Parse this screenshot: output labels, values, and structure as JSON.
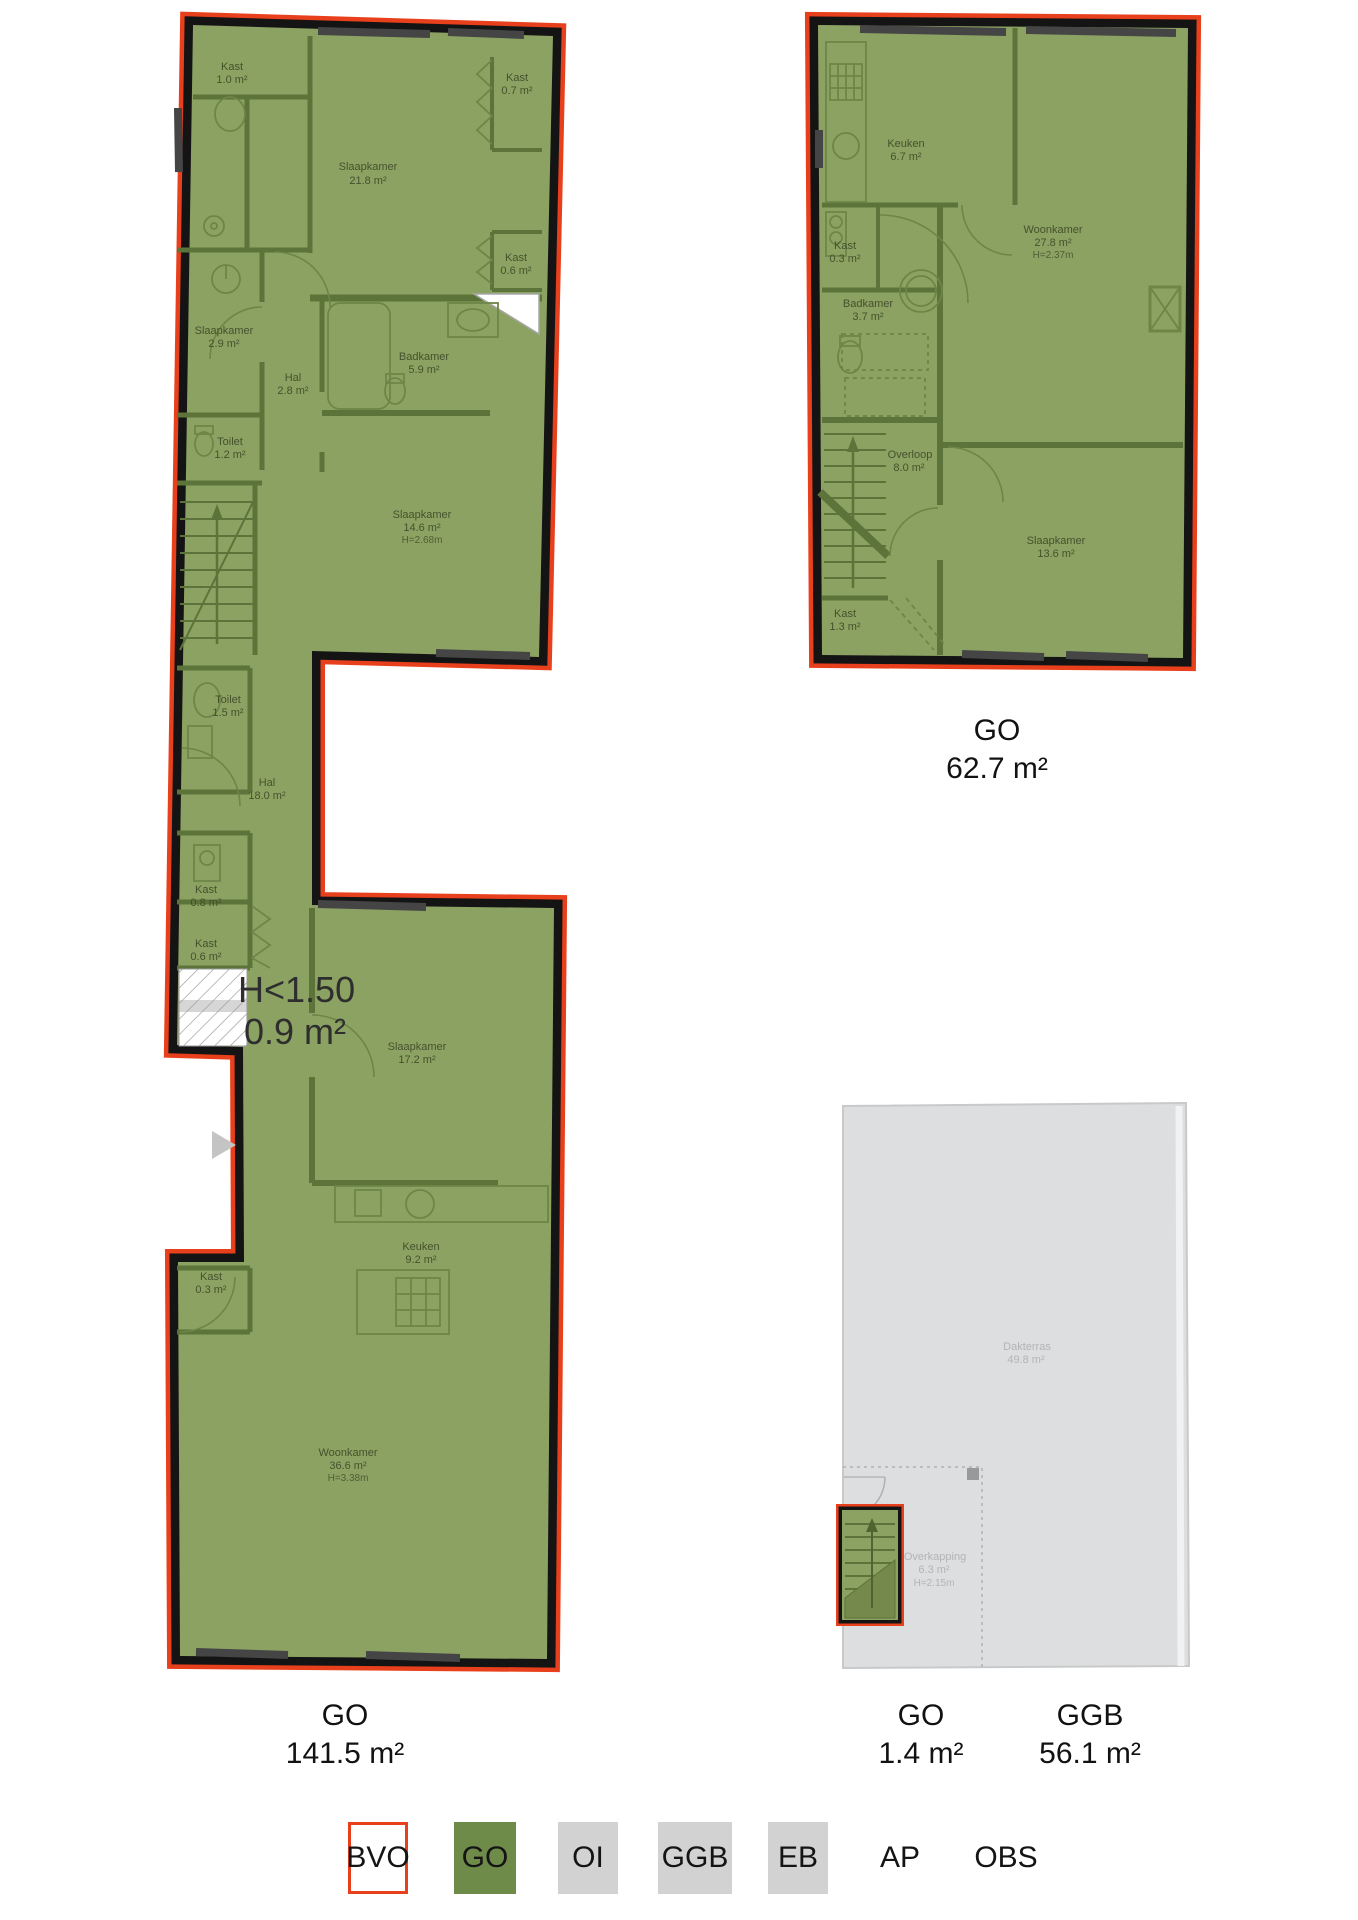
{
  "plans": {
    "plan1": {
      "area_label": {
        "type": "GO",
        "value": "141.5 m²"
      },
      "low_height": {
        "line1": "H<1.50",
        "line2": "0.9 m²"
      },
      "rooms": {
        "kast_tl": {
          "name": "Kast",
          "area": "1.0 m²"
        },
        "slaapkamer_218": {
          "name": "Slaapkamer",
          "area": "21.8 m²"
        },
        "kast_tr": {
          "name": "Kast",
          "area": "0.7 m²"
        },
        "kast_r": {
          "name": "Kast",
          "area": "0.6 m²"
        },
        "slaapkamer_29": {
          "name": "Slaapkamer",
          "area": "2.9 m²"
        },
        "hal_28": {
          "name": "Hal",
          "area": "2.8 m²"
        },
        "badkamer": {
          "name": "Badkamer",
          "area": "5.9 m²"
        },
        "toilet_12": {
          "name": "Toilet",
          "area": "1.2 m²"
        },
        "slaapkamer_146": {
          "name": "Slaapkamer",
          "area": "14.6 m²",
          "height": "H=2.68m"
        },
        "toilet_15": {
          "name": "Toilet",
          "area": "1.5 m²"
        },
        "hal_18": {
          "name": "Hal",
          "area": "18.0 m²"
        },
        "kast_08": {
          "name": "Kast",
          "area": "0.8 m²"
        },
        "kast_06": {
          "name": "Kast",
          "area": "0.6 m²"
        },
        "slaapkamer_172": {
          "name": "Slaapkamer",
          "area": "17.2 m²"
        },
        "keuken": {
          "name": "Keuken",
          "area": "9.2 m²"
        },
        "kast_03": {
          "name": "Kast",
          "area": "0.3 m²"
        },
        "woonkamer": {
          "name": "Woonkamer",
          "area": "36.6 m²",
          "height": "H=3.38m"
        }
      }
    },
    "plan2": {
      "area_label": {
        "type": "GO",
        "value": "62.7 m²"
      },
      "rooms": {
        "keuken": {
          "name": "Keuken",
          "area": "6.7 m²"
        },
        "woonkamer": {
          "name": "Woonkamer",
          "area": "27.8 m²",
          "height": "H=2.37m"
        },
        "kast_03": {
          "name": "Kast",
          "area": "0.3 m²"
        },
        "badkamer": {
          "name": "Badkamer",
          "area": "3.7 m²"
        },
        "overloop": {
          "name": "Overloop",
          "area": "8.0 m²"
        },
        "slaapkamer": {
          "name": "Slaapkamer",
          "area": "13.6 m²"
        },
        "kast_13": {
          "name": "Kast",
          "area": "1.3 m²"
        }
      }
    },
    "plan3": {
      "go_label": {
        "type": "GO",
        "value": "1.4 m²"
      },
      "ggb_label": {
        "type": "GGB",
        "value": "56.1 m²"
      },
      "rooms": {
        "dakterras": {
          "name": "Dakterras",
          "area": "49.8 m²"
        },
        "overkapping": {
          "name": "Overkapping",
          "area": "6.3 m²",
          "height": "H=2.15m"
        }
      }
    }
  },
  "legend": {
    "items": [
      {
        "label": "BVO",
        "swatch": "outline",
        "color": "#E8401C"
      },
      {
        "label": "GO",
        "swatch": "fill",
        "color": "#6F8B49"
      },
      {
        "label": "OI",
        "swatch": "fill",
        "color": "#D2D2D2"
      },
      {
        "label": "GGB",
        "swatch": "fill",
        "color": "#D2D2D2"
      },
      {
        "label": "EB",
        "swatch": "fill",
        "color": "#D2D2D2"
      },
      {
        "label": "AP",
        "swatch": "none",
        "color": ""
      },
      {
        "label": "OBS",
        "swatch": "none",
        "color": ""
      }
    ]
  },
  "colors": {
    "go_fill": "#8CA263",
    "go_swatch": "#6F8B49",
    "bvo_outline": "#E8401C",
    "exterior_wall": "#141414",
    "interior_wall": "#5C7439",
    "fixture_stroke": "#6D8546",
    "ggb_fill": "#DDDEDF",
    "gray_text": "#B2B4B6",
    "window_gray": "#454545"
  }
}
